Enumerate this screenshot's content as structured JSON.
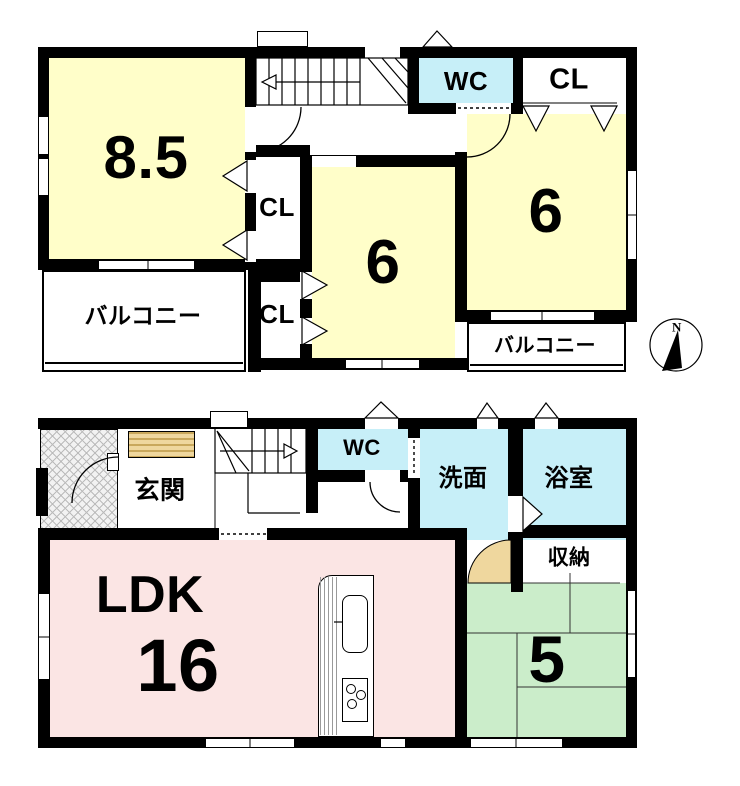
{
  "colors": {
    "wall": "#000000",
    "room-yellow": "#FFFEC9",
    "wet-cyan": "#C7EFF8",
    "ldk-pink": "#FBE5E4",
    "tatami-green": "#CBEDCA",
    "tan": "#EFD79E"
  },
  "floor2": {
    "room_8_5": {
      "label": "8.5"
    },
    "wc": {
      "label": "WC"
    },
    "closet_top": {
      "label": "CL"
    },
    "room_6_east": {
      "label": "6"
    },
    "closet_mid": {
      "label": "CL"
    },
    "room_6_center": {
      "label": "6"
    },
    "closet_low": {
      "label": "CL"
    },
    "balcony_west": {
      "label": "バルコニー"
    },
    "balcony_east": {
      "label": "バルコニー"
    }
  },
  "floor1": {
    "entrance": {
      "label": "玄関"
    },
    "wc": {
      "label": "WC"
    },
    "washroom": {
      "label": "洗面"
    },
    "bathroom": {
      "label": "浴室"
    },
    "ldk": {
      "label": "LDK",
      "size": "16"
    },
    "storage": {
      "label": "収納"
    },
    "tatami_room": {
      "label": "5"
    }
  },
  "compass": {
    "north_label": "N"
  }
}
